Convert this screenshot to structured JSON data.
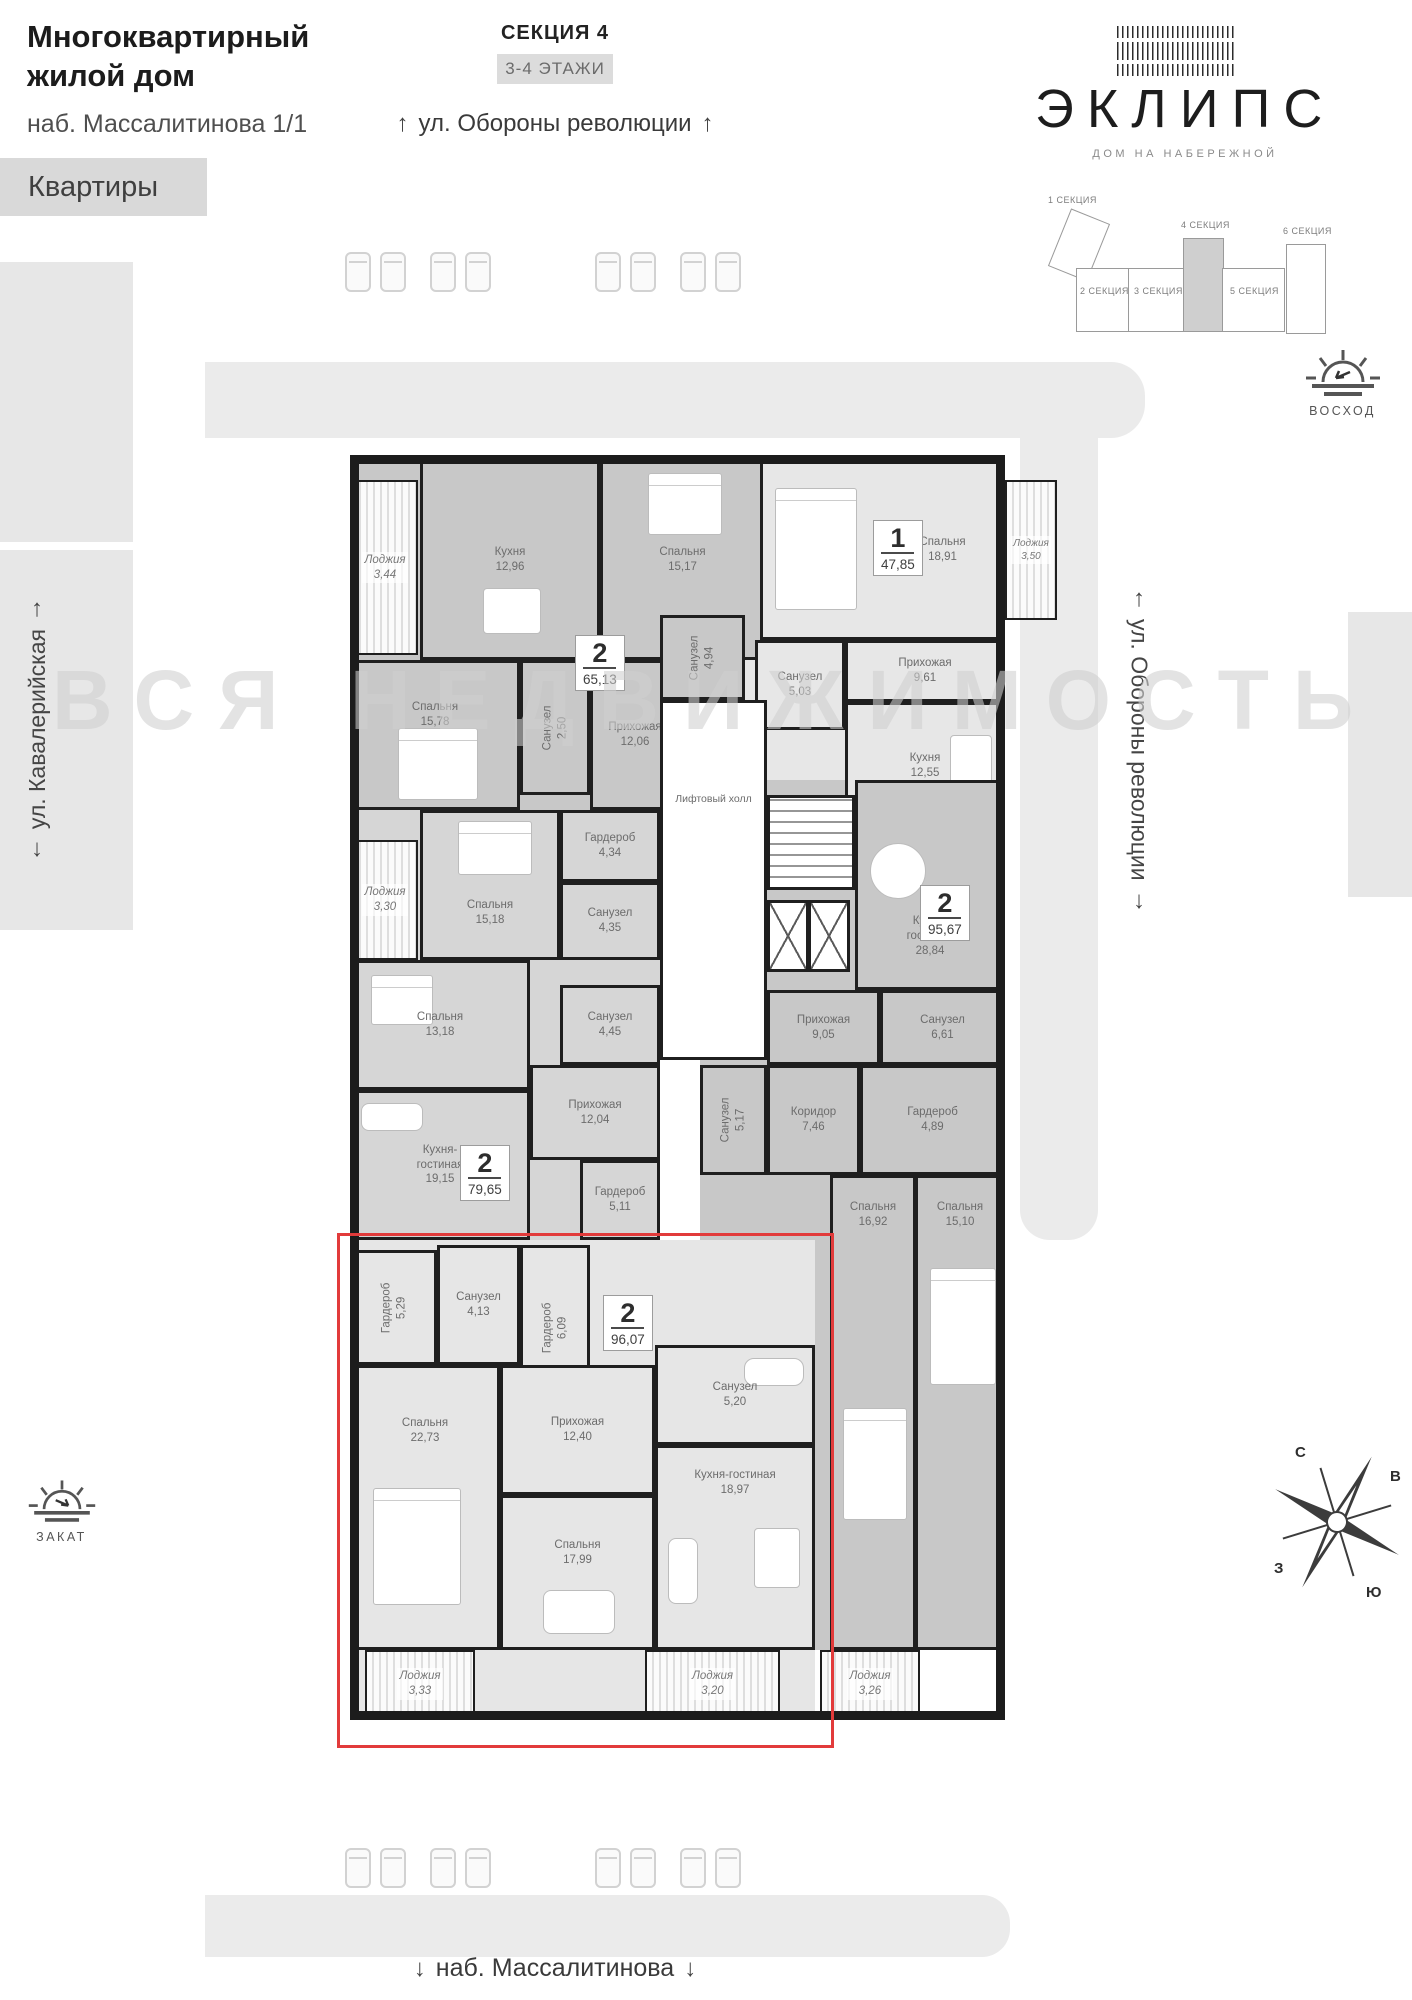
{
  "header": {
    "title_line1": "Многоквартирный",
    "title_line2": "жилой дом",
    "address": "наб. Массалитинова 1/1",
    "flats_button": "Квартиры",
    "section_title": "СЕКЦИЯ 4",
    "floors_badge": "3-4 ЭТАЖИ"
  },
  "logo": {
    "name": "ЭКЛИПС",
    "tagline": "ДОМ НА НАБЕРЕЖНОЙ"
  },
  "sections": {
    "s1": "1 СЕКЦИЯ",
    "s2": "2 СЕКЦИЯ",
    "s3": "3 СЕКЦИЯ",
    "s4": "4 СЕКЦИЯ",
    "s5": "5 СЕКЦИЯ",
    "s6": "6 СЕКЦИЯ"
  },
  "streets": {
    "top": "ул. Обороны революции",
    "right": "ул. Обороны революции",
    "left": "ул. Кавалерийская",
    "bottom": "наб. Массалитинова",
    "arrow_up": "↑",
    "arrow_down": "↓"
  },
  "sun": {
    "sunrise": "ВОСХОД",
    "sunset": "ЗАКАТ"
  },
  "compass": {
    "n": "С",
    "e": "В",
    "w": "З",
    "s": "Ю"
  },
  "watermark": "ВСЯ НЕДВИЖИМОСТЬ",
  "core": {
    "lift_hall": "Лифтовый холл"
  },
  "apartments": [
    {
      "badge_rooms": "2",
      "badge_area": "65,13",
      "rooms": [
        {
          "name": "Лоджия",
          "area": "3,44"
        },
        {
          "name": "Кухня",
          "area": "12,96"
        },
        {
          "name": "Спальня",
          "area": "15,17"
        },
        {
          "name": "Спальня",
          "area": "15,78"
        },
        {
          "name": "Санузел",
          "area": "2,50"
        },
        {
          "name": "Прихожая",
          "area": "12,06"
        },
        {
          "name": "Санузел",
          "area": "4,94"
        }
      ]
    },
    {
      "badge_rooms": "1",
      "badge_area": "47,85",
      "rooms": [
        {
          "name": "Спальня",
          "area": "18,91"
        },
        {
          "name": "Лоджия",
          "area": "3,50"
        },
        {
          "name": "Санузел",
          "area": "5,03"
        },
        {
          "name": "Прихожая",
          "area": "9,61"
        },
        {
          "name": "Кухня",
          "area": "12,55"
        }
      ]
    },
    {
      "badge_rooms": "2",
      "badge_area": "79,65",
      "rooms": [
        {
          "name": "Лоджия",
          "area": "3,30"
        },
        {
          "name": "Спальня",
          "area": "15,18"
        },
        {
          "name": "Гардероб",
          "area": "4,34"
        },
        {
          "name": "Санузел",
          "area": "4,35"
        },
        {
          "name": "Санузел",
          "area": "4,45"
        },
        {
          "name": "Спальня",
          "area": "13,18"
        },
        {
          "name": "Прихожая",
          "area": "12,04"
        },
        {
          "name": "Кухня-гостиная",
          "area": "19,15"
        },
        {
          "name": "Гардероб",
          "area": "5,11"
        }
      ]
    },
    {
      "badge_rooms": "2",
      "badge_area": "95,67",
      "rooms": [
        {
          "name": "Кухня-гостиная",
          "area": "28,84"
        },
        {
          "name": "Прихожая",
          "area": "9,05"
        },
        {
          "name": "Санузел",
          "area": "6,61"
        },
        {
          "name": "Санузел",
          "area": "5,17"
        },
        {
          "name": "Коридор",
          "area": "7,46"
        },
        {
          "name": "Гардероб",
          "area": "4,89"
        },
        {
          "name": "Спальня",
          "area": "16,92"
        },
        {
          "name": "Спальня",
          "area": "15,10"
        },
        {
          "name": "Лоджия",
          "area": "3,26"
        }
      ]
    },
    {
      "badge_rooms": "2",
      "badge_area": "96,07",
      "highlighted": true,
      "rooms": [
        {
          "name": "Гардероб",
          "area": "5,29"
        },
        {
          "name": "Санузел",
          "area": "4,13"
        },
        {
          "name": "Гардероб",
          "area": "6,09"
        },
        {
          "name": "Санузел",
          "area": "5,20"
        },
        {
          "name": "Спальня",
          "area": "22,73"
        },
        {
          "name": "Прихожая",
          "area": "12,40"
        },
        {
          "name": "Кухня-гостиная",
          "area": "18,97"
        },
        {
          "name": "Спальня",
          "area": "17,99"
        },
        {
          "name": "Лоджия",
          "area": "3,33"
        },
        {
          "name": "Лоджия",
          "area": "3,20"
        }
      ]
    }
  ]
}
